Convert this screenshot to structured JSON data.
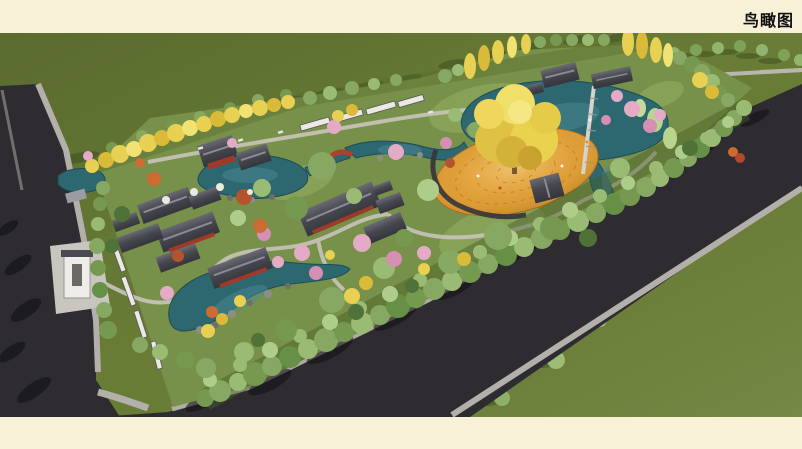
{
  "header": {
    "title": "鸟瞰图"
  },
  "scene": {
    "type": "architectural-aerial-rendering",
    "subject": "chinese-garden-park-bird-eye-view",
    "features": [
      "ponds",
      "golden-plaza",
      "large-ginkgo-tree",
      "chinese-roof-buildings",
      "perimeter-tree-belt",
      "asphalt-roads",
      "sidewalks",
      "entrance-gate",
      "pedestrian-bridge",
      "red-arch-bridge",
      "cherry-blossom-trees",
      "ginkgo-rows",
      "rockery"
    ]
  },
  "palette": {
    "band_cream": "#f9f0d8",
    "field_green": "#6b7f37",
    "garden_green": "#78914a",
    "water_teal": "#2d6770",
    "plaza_gold": "#d9952e",
    "ginkgo_yellow": "#e8d24f",
    "blossom_pink": "#e3a8c4",
    "road_asphalt": "#2f2c31",
    "sidewalk_gray": "#b3b0ab",
    "roof_gray": "#42424a"
  }
}
